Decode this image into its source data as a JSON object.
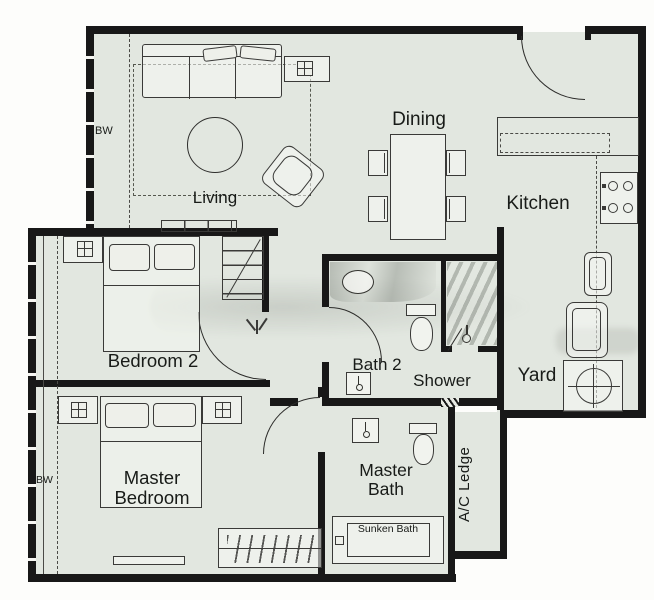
{
  "rooms": {
    "living": "Living",
    "dining": "Dining",
    "kitchen": "Kitchen",
    "yard": "Yard",
    "bedroom2": "Bedroom 2",
    "master_bedroom": "Master Bedroom",
    "bath2": "Bath 2",
    "shower": "Shower",
    "master_bath": "Master Bath",
    "ac_ledge": "A/C Ledge"
  },
  "fixtures": {
    "sunken_bath": "Sunken Bath"
  },
  "annotations": {
    "bay_window_living": "BW",
    "bay_window_master": "BW"
  },
  "colors": {
    "floor": "#e2e7e0",
    "wall": "#181818",
    "furniture_line": "#3a3a38",
    "label_text": "#181b18",
    "paper": "#fdfdfb"
  },
  "icons": {
    "lamp_icon": "grid-cross",
    "plant_icon": "stem-lines",
    "stove_burner_icon": "circle",
    "washing_machine_icon": "drum-circle-cross",
    "shower_head_icon": "spray-circle",
    "faucet_icon": "dot-stem",
    "hanger_rail_icon": "slash-ticks"
  }
}
